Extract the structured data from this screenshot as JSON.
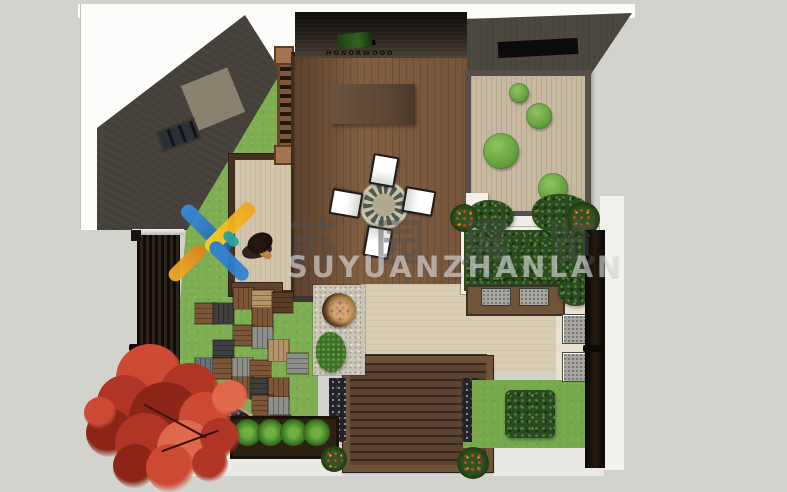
{
  "watermark": {
    "chinese": "苏园展览",
    "latin": "SUYUANZHANLAN"
  },
  "equipment_label": "HONORWOOD",
  "palette": {
    "ground_gray": "#d2d3cd",
    "paper_white": "#fcfcfa",
    "roof_charcoal": "#45413a",
    "deck_brown": "#8a6547",
    "dark_platform": "#5c4230",
    "lawn_green": "#7fae52",
    "courtyard_tan": "#c8baa2",
    "maple_red": "#b03524",
    "logo_blue": "#2f7fd0",
    "logo_yellow": "#f5b41e",
    "tiles": {
      "brown": "#7d5637",
      "dkbrown": "#5a3c24",
      "darkgray": "#3e3e3e",
      "gray": "#8e8e8a",
      "bluegray": "#67737a",
      "tan": "#b59468"
    },
    "maple_tones": {
      "r1": "#b03524",
      "r2": "#cc4a33",
      "r3": "#8c2417",
      "r4": "#e0684d"
    }
  },
  "plan": {
    "paver_tiles": [
      {
        "x": 195,
        "y": 303,
        "c": "brown",
        "o": "h"
      },
      {
        "x": 213,
        "y": 303,
        "c": "darkgray",
        "o": "v"
      },
      {
        "x": 233,
        "y": 288,
        "c": "brown",
        "o": "v"
      },
      {
        "x": 252,
        "y": 290,
        "c": "tan",
        "o": "h"
      },
      {
        "x": 272,
        "y": 292,
        "c": "dkbrown",
        "o": "h"
      },
      {
        "x": 252,
        "y": 308,
        "c": "brown",
        "o": "v"
      },
      {
        "x": 233,
        "y": 325,
        "c": "brown",
        "o": "h"
      },
      {
        "x": 252,
        "y": 327,
        "c": "gray",
        "o": "v"
      },
      {
        "x": 213,
        "y": 340,
        "c": "darkgray",
        "o": "h"
      },
      {
        "x": 195,
        "y": 358,
        "c": "bluegray",
        "o": "v"
      },
      {
        "x": 213,
        "y": 358,
        "c": "brown",
        "o": "h"
      },
      {
        "x": 232,
        "y": 358,
        "c": "gray",
        "o": "v"
      },
      {
        "x": 250,
        "y": 360,
        "c": "brown",
        "o": "h"
      },
      {
        "x": 268,
        "y": 340,
        "c": "tan",
        "o": "v"
      },
      {
        "x": 287,
        "y": 353,
        "c": "gray",
        "o": "h"
      },
      {
        "x": 232,
        "y": 377,
        "c": "brown",
        "o": "v"
      },
      {
        "x": 250,
        "y": 378,
        "c": "darkgray",
        "o": "h"
      },
      {
        "x": 268,
        "y": 378,
        "c": "brown",
        "o": "v"
      },
      {
        "x": 252,
        "y": 395,
        "c": "brown",
        "o": "h"
      },
      {
        "x": 268,
        "y": 397,
        "c": "gray",
        "o": "v"
      },
      {
        "x": 270,
        "y": 415,
        "c": "dkbrown",
        "o": "v"
      }
    ],
    "topiary_bushes": [
      {
        "cx": 519,
        "cy": 93,
        "r": 10
      },
      {
        "cx": 539,
        "cy": 116,
        "r": 13
      },
      {
        "cx": 501,
        "cy": 151,
        "r": 18
      },
      {
        "cx": 553,
        "cy": 188,
        "r": 15
      }
    ],
    "table": {
      "cx": 384,
      "cy": 205,
      "r": 21
    },
    "chairs": [
      {
        "x": 371,
        "y": 155,
        "rot": 10
      },
      {
        "x": 406,
        "y": 186,
        "rot": 100
      },
      {
        "x": 365,
        "y": 227,
        "rot": 190
      },
      {
        "x": 333,
        "y": 188,
        "rot": 280
      }
    ],
    "maple_blobs": [
      {
        "x": 150,
        "y": 378,
        "r": 34,
        "c": "r2"
      },
      {
        "x": 190,
        "y": 393,
        "r": 30,
        "c": "r1"
      },
      {
        "x": 125,
        "y": 403,
        "r": 28,
        "c": "r1"
      },
      {
        "x": 165,
        "y": 418,
        "r": 36,
        "c": "r3"
      },
      {
        "x": 205,
        "y": 418,
        "r": 26,
        "c": "r2"
      },
      {
        "x": 110,
        "y": 433,
        "r": 24,
        "c": "r3"
      },
      {
        "x": 145,
        "y": 443,
        "r": 30,
        "c": "r1"
      },
      {
        "x": 185,
        "y": 448,
        "r": 28,
        "c": "r4"
      },
      {
        "x": 220,
        "y": 438,
        "r": 20,
        "c": "r1"
      },
      {
        "x": 135,
        "y": 466,
        "r": 22,
        "c": "r3"
      },
      {
        "x": 170,
        "y": 468,
        "r": 24,
        "c": "r2"
      },
      {
        "x": 210,
        "y": 464,
        "r": 18,
        "c": "r1"
      },
      {
        "x": 230,
        "y": 398,
        "r": 18,
        "c": "r4"
      },
      {
        "x": 100,
        "y": 413,
        "r": 16,
        "c": "r2"
      }
    ],
    "bottom_shrubs": [
      {
        "x": 321,
        "y": 446,
        "s": 26
      },
      {
        "x": 457,
        "y": 447,
        "s": 32
      }
    ],
    "flower_pots": [
      {
        "x": 450,
        "y": 204,
        "s": 28
      },
      {
        "x": 566,
        "y": 202,
        "s": 34
      }
    ],
    "hostas": [
      {
        "x": 234,
        "y": 419,
        "s": 27
      },
      {
        "x": 257,
        "y": 419,
        "s": 27
      },
      {
        "x": 280,
        "y": 419,
        "s": 27
      },
      {
        "x": 303,
        "y": 419,
        "s": 27
      }
    ],
    "canopy_blobs": [
      {
        "x": 468,
        "y": 200,
        "w": 46,
        "h": 32
      },
      {
        "x": 532,
        "y": 194,
        "w": 60,
        "h": 40
      },
      {
        "x": 558,
        "y": 276,
        "w": 36,
        "h": 30
      },
      {
        "x": 470,
        "y": 240,
        "w": 50,
        "h": 40
      },
      {
        "x": 518,
        "y": 240,
        "w": 62,
        "h": 42
      }
    ],
    "bench_cushions": [
      {
        "x": 481,
        "y": 288
      },
      {
        "x": 519,
        "y": 288
      }
    ],
    "stone_pads": [
      {
        "x": 562,
        "y": 314
      },
      {
        "x": 562,
        "y": 352
      }
    ]
  }
}
